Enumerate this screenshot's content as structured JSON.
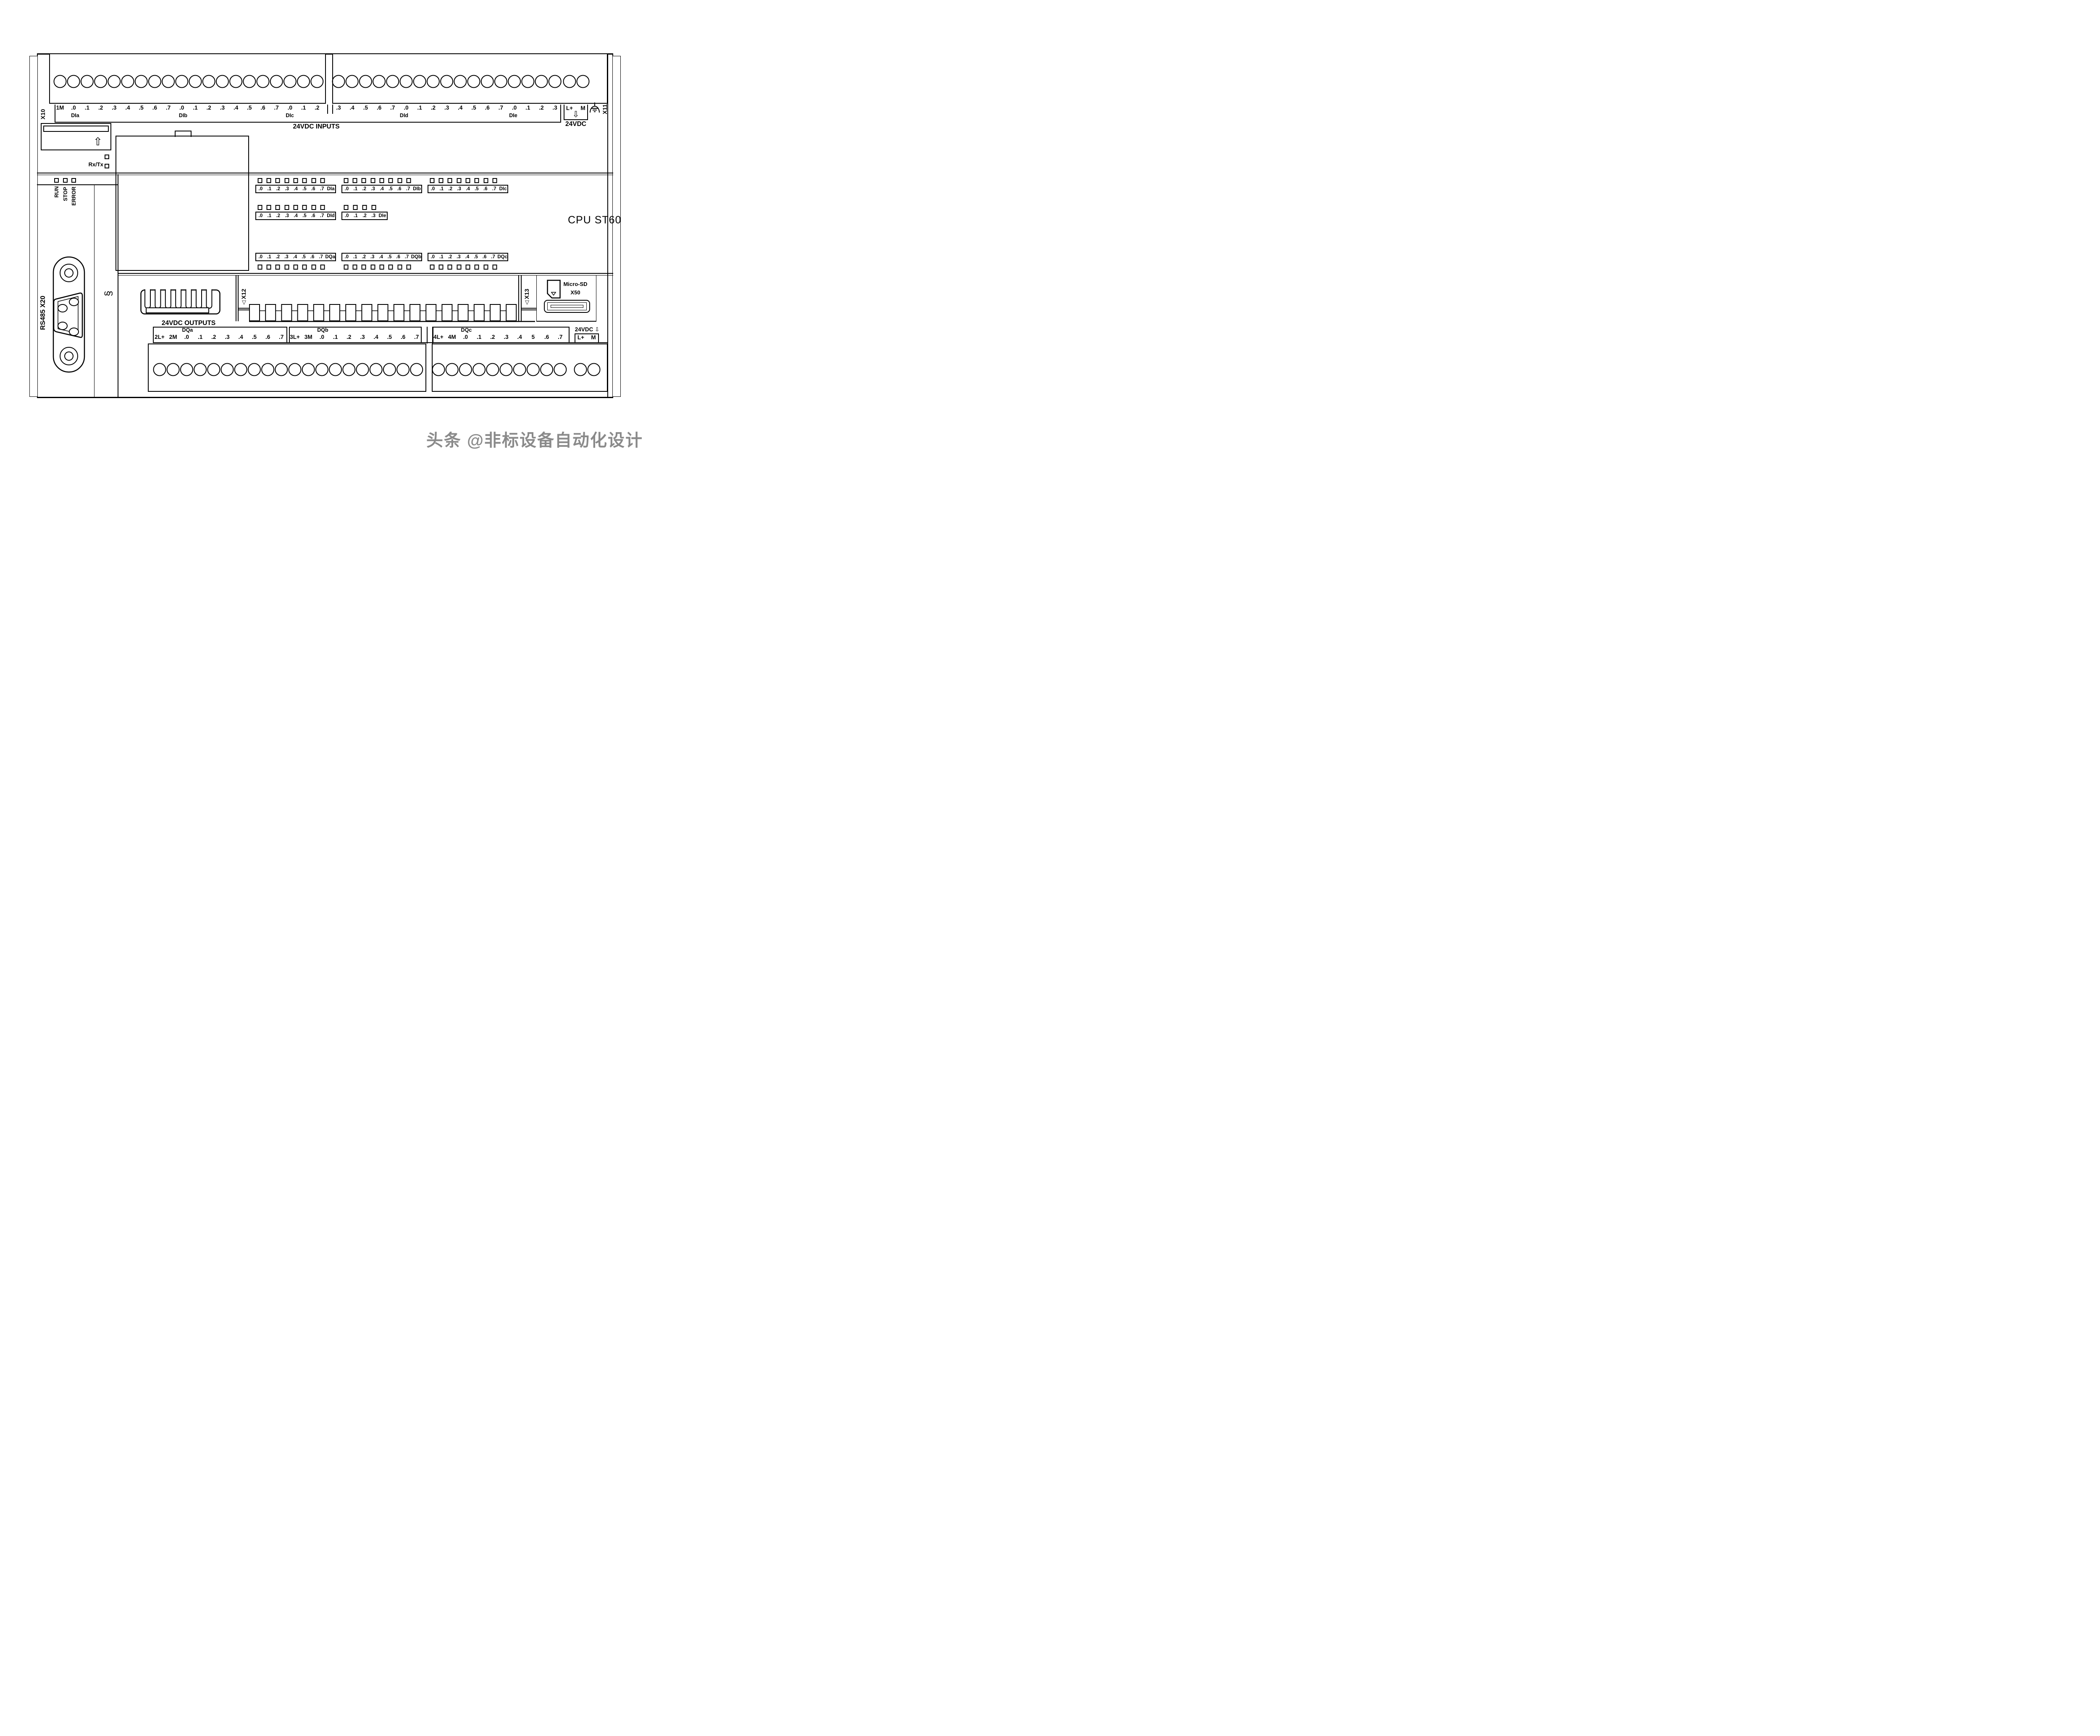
{
  "device": {
    "model": "CPU ST60"
  },
  "top": {
    "x10": "X10",
    "x11": "X11",
    "inputs_caption": "24VDC INPUTS",
    "block_a_labels": [
      "1M",
      ".0",
      ".1",
      ".2",
      ".3",
      ".4",
      ".5",
      ".6",
      ".7",
      ".0",
      ".1",
      ".2",
      ".3",
      ".4",
      ".5",
      ".6",
      ".7",
      ".0",
      ".1",
      ".2"
    ],
    "block_b_labels": [
      ".3",
      ".4",
      ".5",
      ".6",
      ".7",
      ".0",
      ".1",
      ".2",
      ".3",
      ".4",
      ".5",
      ".6",
      ".7",
      ".0",
      ".1",
      ".2",
      ".3"
    ],
    "group_labels": [
      "DIa",
      "DIb",
      "DIc",
      "DId",
      "DIe"
    ],
    "power": {
      "l_plus": "L+",
      "m": "M",
      "caption": "24VDC"
    }
  },
  "status": {
    "rx_tx": "Rx/Tx",
    "leds": [
      "RUN",
      "STOP",
      "ERROR"
    ]
  },
  "led_rows": {
    "row1": [
      {
        "name": "DIa",
        "bits": [
          ".0",
          ".1",
          ".2",
          ".3",
          ".4",
          ".5",
          ".6",
          ".7"
        ]
      },
      {
        "name": "DIb",
        "bits": [
          ".0",
          ".1",
          ".2",
          ".3",
          ".4",
          ".5",
          ".6",
          ".7"
        ]
      },
      {
        "name": "DIc",
        "bits": [
          ".0",
          ".1",
          ".2",
          ".3",
          ".4",
          ".5",
          ".6",
          ".7"
        ]
      }
    ],
    "row2": [
      {
        "name": "DId",
        "bits": [
          ".0",
          ".1",
          ".2",
          ".3",
          ".4",
          ".5",
          ".6",
          ".7"
        ]
      },
      {
        "name": "DIe",
        "bits": [
          ".0",
          ".1",
          ".2",
          ".3"
        ]
      }
    ],
    "dq": [
      {
        "name": "DQa",
        "bits": [
          ".0",
          ".1",
          ".2",
          ".3",
          ".4",
          ".5",
          ".6",
          ".7"
        ]
      },
      {
        "name": "DQb",
        "bits": [
          ".0",
          ".1",
          ".2",
          ".3",
          ".4",
          ".5",
          ".6",
          ".7"
        ]
      },
      {
        "name": "DQc",
        "bits": [
          ".0",
          ".1",
          ".2",
          ".3",
          ".4",
          ".5",
          ".6",
          ".7"
        ]
      }
    ]
  },
  "bottom": {
    "outputs_caption": "24VDC OUTPUTS",
    "x12": "X12",
    "x13": "X13",
    "rs485": "RS485 X20",
    "groups": [
      {
        "name": "DQa",
        "labels": [
          "2L+",
          "2M",
          ".0",
          ".1",
          ".2",
          ".3",
          ".4",
          ".5",
          ".6",
          ".7"
        ]
      },
      {
        "name": "DQb",
        "labels": [
          "3L+",
          "3M",
          ".0",
          ".1",
          ".2",
          ".3",
          ".4",
          ".5",
          ".6",
          ".7"
        ]
      },
      {
        "name": "DQc",
        "labels": [
          "4L+",
          "4M",
          ".0",
          ".1",
          ".2",
          ".3",
          ".4",
          "5",
          ".6",
          ".7"
        ]
      }
    ],
    "power": {
      "caption": "24VDC",
      "l_plus": "L+",
      "m": "M"
    },
    "microsd": {
      "line1": "Micro-SD",
      "line2": "X50"
    }
  },
  "icons": {
    "card_eject_up_arrow": "⇧",
    "power_down_arrow": "⇩",
    "marker_triangle": "▽",
    "shield_clamp": "§"
  },
  "watermark": "头条 @非标设备自动化设计"
}
